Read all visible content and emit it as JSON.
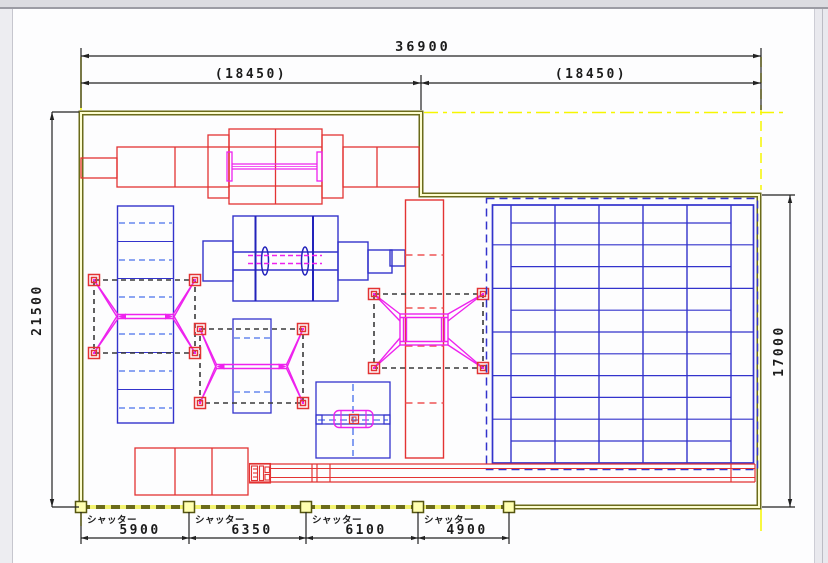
{
  "drawing": {
    "title_note": "factory floor plan with equipment layout",
    "dims": {
      "overall_width": "36900",
      "left_half_width": "(18450)",
      "right_half_width": "(18450)",
      "height_left": "21500",
      "height_right": "17000"
    },
    "shutters": [
      {
        "label": "シャッター",
        "width": "5900"
      },
      {
        "label": "シャッター",
        "width": "6350"
      },
      {
        "label": "シャッター",
        "width": "6100"
      },
      {
        "label": "シャッター",
        "width": "4900"
      }
    ],
    "colors": {
      "wall_olive": "#6b6b1a",
      "wall_fill_yellow": "#fdfdd0",
      "centerline_yellow": "#ffff00",
      "equipment_red": "#e33333",
      "equipment_blue": "#3333cc",
      "equipment_light_blue_dashed": "#6688ee",
      "equipment_magenta": "#ee22ee",
      "dimension_black": "#222222",
      "hoist_zone_dashed_black": "#3a3a3a"
    }
  }
}
